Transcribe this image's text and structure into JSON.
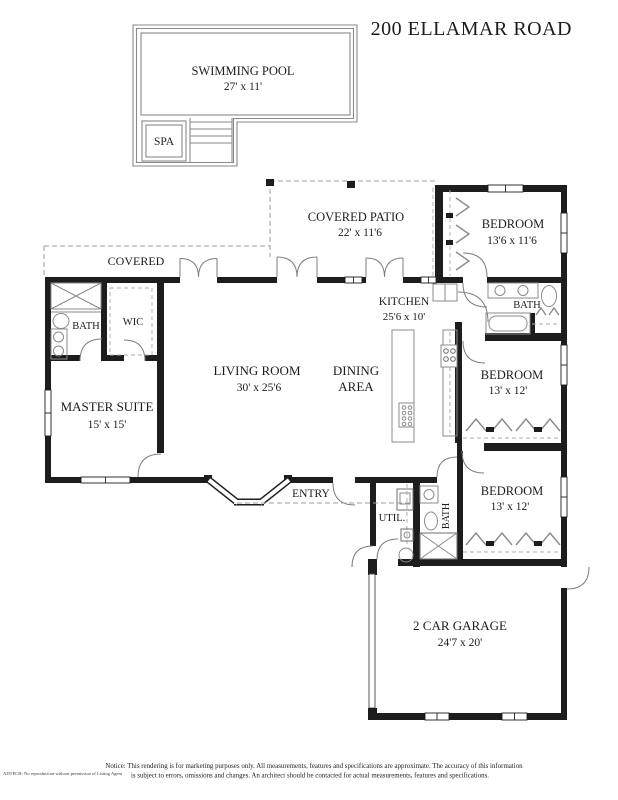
{
  "title": "200 ELLAMAR ROAD",
  "pool": {
    "name": "SWIMMING POOL",
    "dims": "27' x 11'",
    "spa": "SPA"
  },
  "rooms": {
    "covered_patio": {
      "name": "COVERED PATIO",
      "dims": "22' x 11'6"
    },
    "covered_walkway": {
      "name": "COVERED"
    },
    "bedroom_ne": {
      "name": "BEDROOM",
      "dims": "13'6 x 11'6"
    },
    "kitchen": {
      "name": "KITCHEN",
      "dims": "25'6 x 10'"
    },
    "bath_ne": {
      "name": "BATH"
    },
    "bath_master": {
      "name": "BATH"
    },
    "wic": {
      "name": "WIC"
    },
    "living_room": {
      "name": "LIVING ROOM",
      "dims": "30' x 25'6"
    },
    "dining": {
      "line1": "DINING",
      "line2": "AREA"
    },
    "master_suite": {
      "name": "MASTER SUITE",
      "dims": "15' x 15'"
    },
    "bedroom_e": {
      "name": "BEDROOM",
      "dims": "13' x 12'"
    },
    "bedroom_se": {
      "name": "BEDROOM",
      "dims": "13' x 12'"
    },
    "entry": {
      "name": "ENTRY"
    },
    "utility": {
      "name": "UTIL."
    },
    "bath_hall": {
      "name": "BATH"
    },
    "garage": {
      "name": "2 CAR GARAGE",
      "dims": "24'7 x 20'"
    }
  },
  "footer": {
    "notice_line1": "Notice: This rendering is for marketing purposes only. All measurements, features and specifications are approximate. The accuracy of this information",
    "notice_line2": "is subject to errors, omissions and changes. An architect should be contacted for actual measurements, features and specifications.",
    "watermark": "ADTECH: No reproduction without permission of Listing Agent"
  }
}
